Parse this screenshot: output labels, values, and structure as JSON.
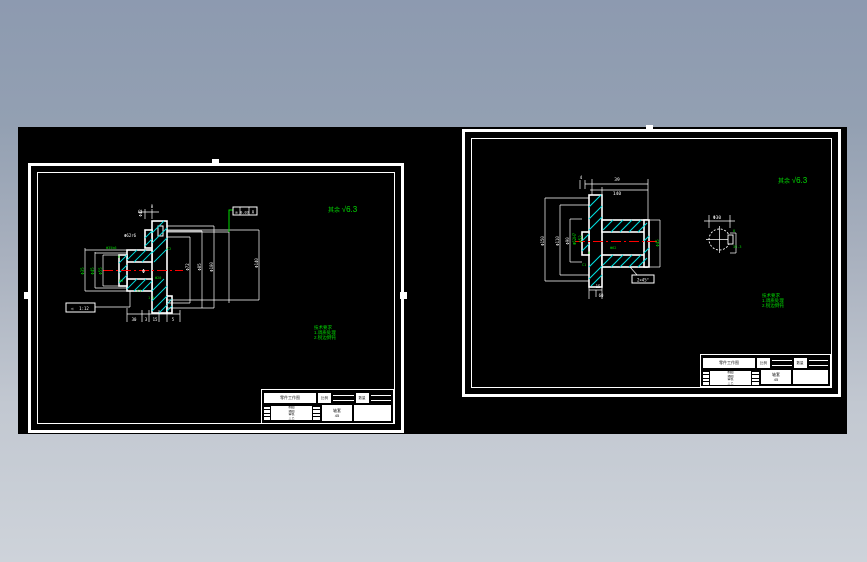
{
  "notes": {
    "surface_prefix": "其余",
    "surface_value": "√6.3",
    "tech_title": "技术要求",
    "tech_line1": "1.调质处理",
    "tech_line2": "2.锐边倒钝"
  },
  "title_block": {
    "name_bar": "零件工作图",
    "cell1": "比例",
    "cell2": "数量",
    "row1": "制图",
    "row2": "描图",
    "row3": "审核",
    "row4": "工艺",
    "part_line1": "轴套",
    "part_line2": "45"
  },
  "left": {
    "dims": {
      "top_rot": "Φ42",
      "top_small": "8",
      "hub_label": "Φ62r6",
      "bore_phi": "Φ",
      "l1": "Φ35",
      "l2": "Φ45",
      "l3": "Φ55",
      "r1": "Φ72",
      "r2": "Φ85",
      "r3": "Φ100",
      "r4": "Φ140",
      "b1": "30",
      "b2": "3",
      "b3": "15",
      "b4": "5",
      "taper_sym": "◁",
      "taper": "1:12"
    },
    "gdt": {
      "sym": "◎",
      "tol": "0.03",
      "ref": "A"
    },
    "micro": {
      "m1": "Φ35k6",
      "m2": "6",
      "m3": "C2",
      "m4": "Φ20",
      "m5": "R3",
      "m6": "C1",
      "m7": "1.5"
    }
  },
  "right": {
    "dims": {
      "top1": "39",
      "top2": "140",
      "top_small": "4",
      "l1": "Φ150",
      "l2": "Φ110",
      "l3": "Φ90",
      "bore1": "Φ62H7",
      "bore2": "Φ52",
      "r1": "Φ45",
      "b1": "15",
      "b2": "60",
      "chamfer": "2×45°"
    },
    "circle": {
      "dia": "Φ30",
      "key_w": "8",
      "key_h": "33.3"
    },
    "micro": {
      "m1": "6",
      "m2": "C1",
      "m3": "Φ62"
    }
  }
}
